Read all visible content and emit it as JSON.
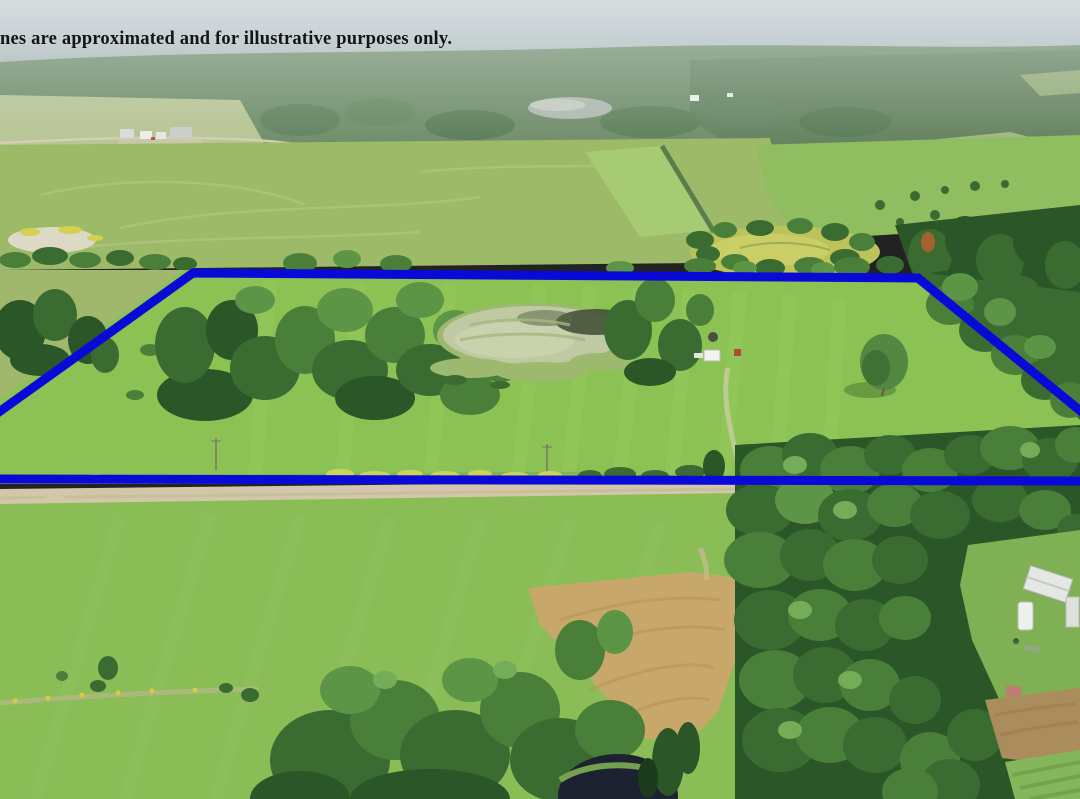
{
  "disclaimer": {
    "text": "nes are approximated and for illustrative purposes only."
  },
  "boundary_overlay": {
    "color": "#0a0ad8",
    "stroke_width": "9",
    "parcel_outline_points": "-15,422 193,273 918,278 1094,422",
    "bottom_line_points": "-10,479 1090,481"
  }
}
